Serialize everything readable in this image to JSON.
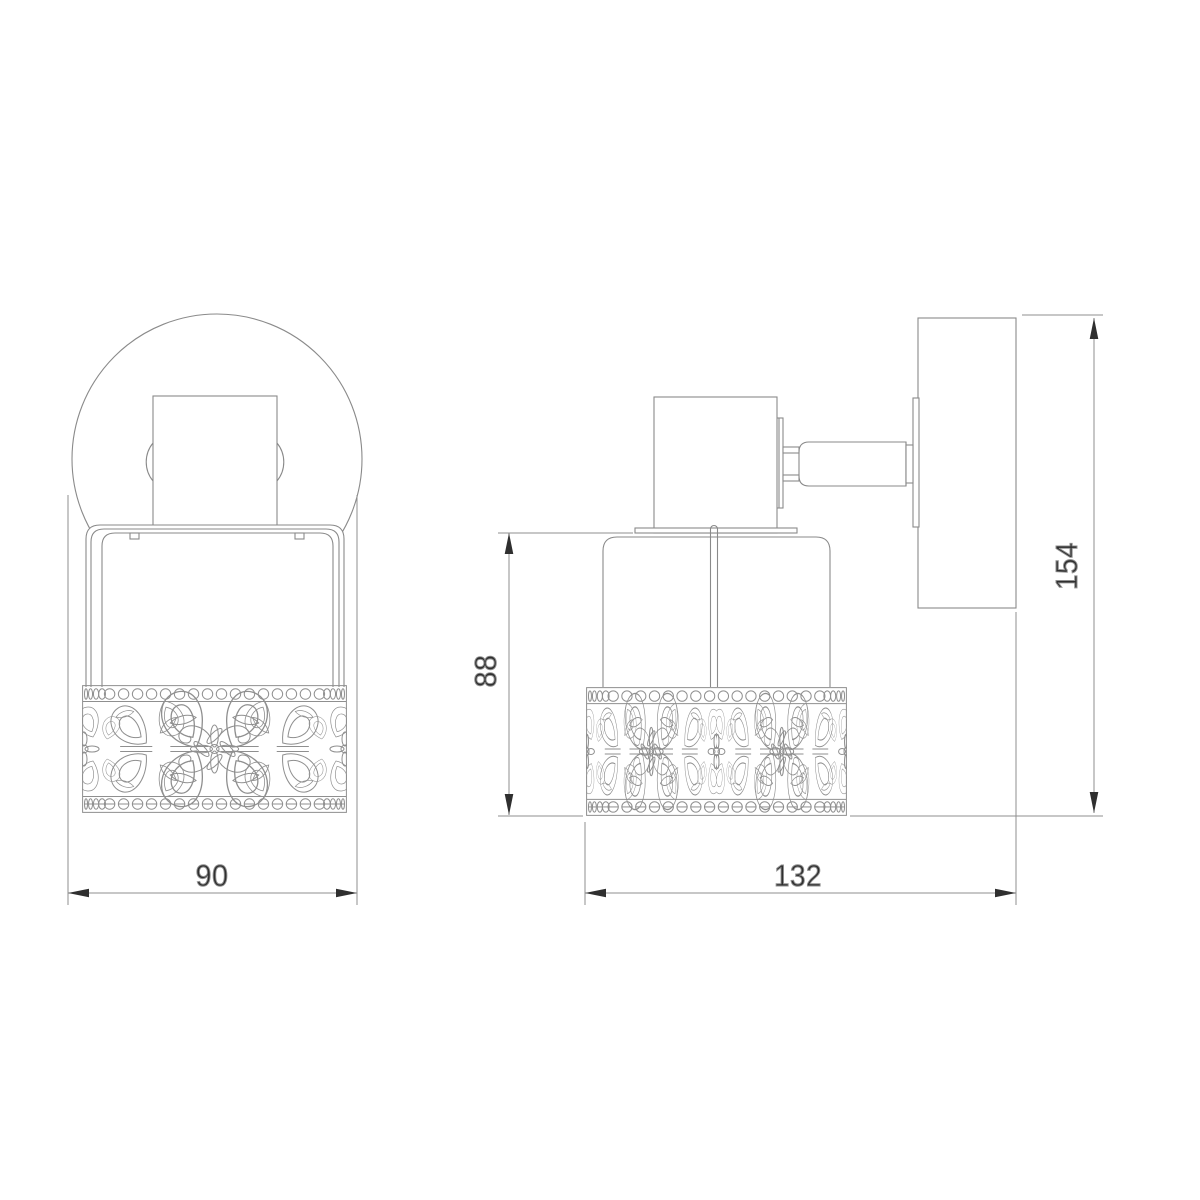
{
  "drawing": {
    "type": "wall-spotlight dimension drawing",
    "dimensions": {
      "front_width": {
        "label": "90"
      },
      "depth": {
        "label": "132"
      },
      "shade_height": {
        "label": "88"
      },
      "overall_height": {
        "label": "154"
      }
    },
    "colors": {
      "background": "#ffffff",
      "line": "#8a8a8a",
      "text": "#2f2f2f",
      "arrow": "#2f2f2f"
    }
  }
}
